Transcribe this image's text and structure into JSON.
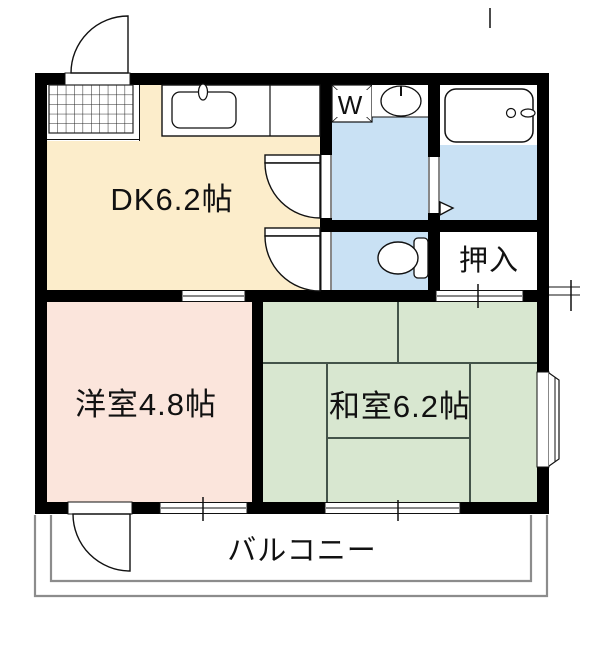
{
  "floorplan": {
    "rooms": {
      "dk": {
        "label": "DK6.2帖",
        "fill": "#FCEDCB"
      },
      "western_room": {
        "label": "洋室4.8帖",
        "fill": "#FBE5DC"
      },
      "japanese_room": {
        "label": "和室6.2帖",
        "fill": "#D8E7D0"
      },
      "closet": {
        "label": "押入",
        "fill": "#FFFFFF"
      },
      "balcony": {
        "label": "バルコニー"
      },
      "laundry": {
        "label": "W"
      }
    },
    "colors": {
      "wet_area": "#C9E1F4",
      "wall": "#000000",
      "balcony_line": "#8C8C8C",
      "tatami_line": "#44544A"
    },
    "icons": [
      "entrance-door-icon",
      "entrance-tile-icon",
      "kitchen-sink-icon",
      "washing-machine-icon",
      "washbasin-icon",
      "bathtub-icon",
      "toilet-icon",
      "bay-window-icon",
      "balcony-door-icon",
      "interior-door-icon",
      "window-icon"
    ]
  }
}
